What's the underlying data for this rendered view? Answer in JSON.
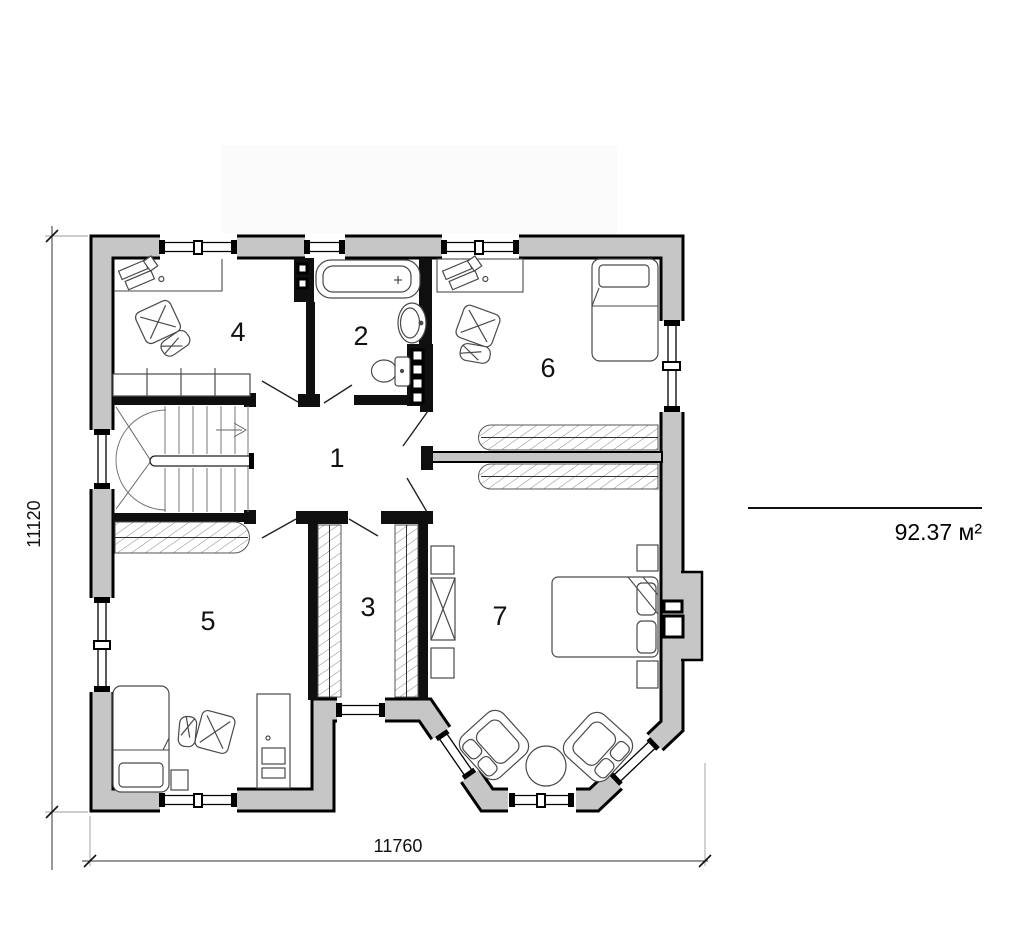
{
  "plan": {
    "rooms": [
      {
        "number": "1"
      },
      {
        "number": "2"
      },
      {
        "number": "3"
      },
      {
        "number": "4"
      },
      {
        "number": "5"
      },
      {
        "number": "6"
      },
      {
        "number": "7"
      }
    ],
    "dimensions": {
      "width_label": "11760",
      "height_label": "11120"
    },
    "area_label": "92.37 м²"
  },
  "colors": {
    "wall_fill": "#c6c6c6",
    "wall_outline": "#000000",
    "furniture_line": "#4a4a4a",
    "dimension_line": "#333333"
  }
}
